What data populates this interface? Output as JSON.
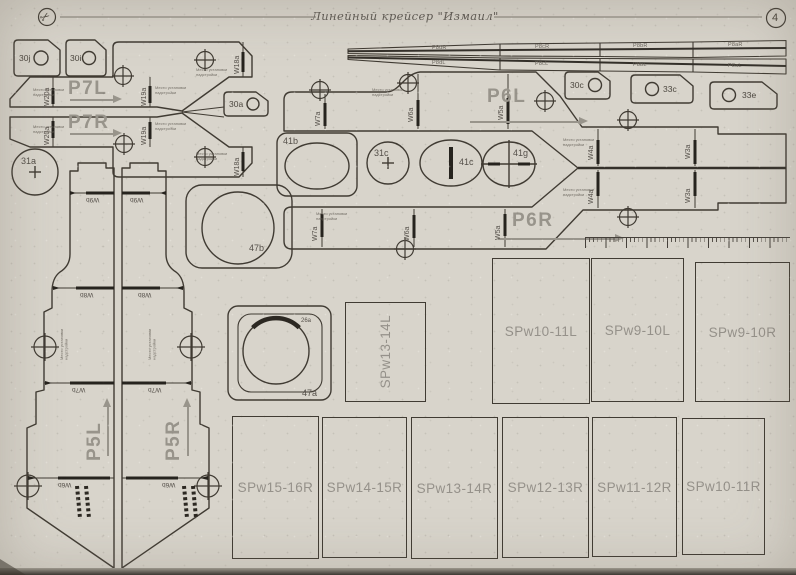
{
  "header": {
    "title": "Линейный крейсер \"Измаил\"",
    "page_number": "4",
    "logo_glyph": "✂"
  },
  "colors": {
    "paper": "#d8d4cb",
    "ink": "#403b33",
    "label_grey": "#98948b"
  },
  "labels": {
    "t30j": "30j",
    "t30i": "30i",
    "t30a": "30a",
    "t30c": "30c",
    "t33c": "33c",
    "t33e": "33e",
    "p7l": "P7L",
    "p7r": "P7R",
    "p6l": "P6L",
    "p6r": "P6R",
    "p5l": "P5L",
    "p5r": "P5R",
    "w20a": "W20a",
    "w19a": "W19a",
    "w18a": "W18a",
    "w7a": "W7a",
    "w6a": "W6a",
    "w5a": "W5a",
    "w4a": "W4a",
    "w3a": "W3a",
    "w9b": "W9b",
    "w8b": "W8b",
    "w7b": "W7b",
    "w6b": "W6b",
    "r31a": "31a",
    "r31c": "31c",
    "r41b": "41b",
    "r41c": "41c",
    "r41g": "41g",
    "r47a": "47a",
    "r47b": "47b",
    "r26a": "26a"
  },
  "barrels": {
    "d_top": "P8dR",
    "d_bot": "P8dL",
    "c_top": "P8cR",
    "c_bot": "P8cL",
    "b_top": "P8bR",
    "b_bot": "P8bL",
    "a_top": "P8aR",
    "a_bot": "P8aL"
  },
  "panels": {
    "mid": "SPw13-14L",
    "right": [
      "SPw10-11L",
      "SPw9-10L",
      "SPw9-10R"
    ],
    "bottom": [
      "SPw15-16R",
      "SPw14-15R",
      "SPw13-14R",
      "SPw12-13R",
      "SPw11-12R",
      "SPw10-11R"
    ]
  },
  "note": {
    "l1": "Место установки",
    "l2": "надстройки"
  }
}
